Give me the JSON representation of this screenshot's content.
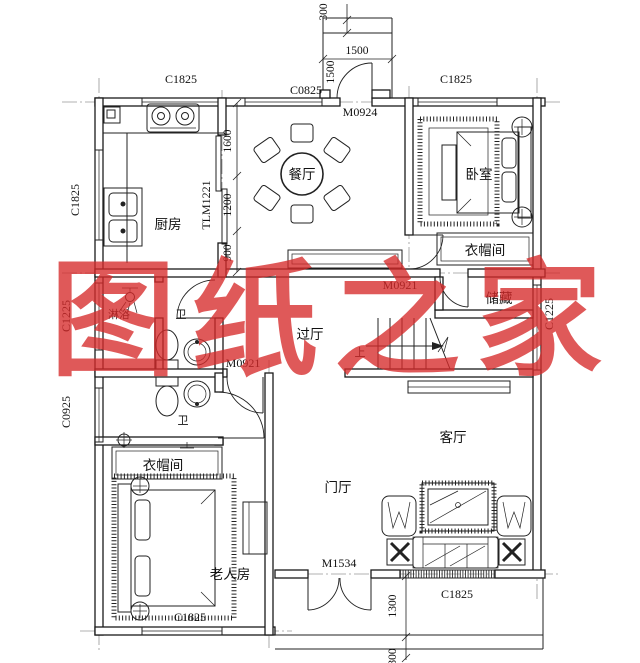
{
  "watermark": {
    "text": "图纸之家",
    "color": "#d62a2a"
  },
  "rooms": {
    "kitchen": "厨房",
    "dining": "餐厅",
    "bedroom": "卧室",
    "cloakroom_top": "衣帽间",
    "storage": "储藏",
    "hallway": "过厅",
    "shower": "淋浴",
    "bath_upper": "卫",
    "bath_lower": "卫",
    "cloakroom_bottom": "衣帽间",
    "elder_room": "老人房",
    "foyer": "门厅",
    "living_room": "客厅",
    "stairs_up": "上"
  },
  "openings": {
    "win_top_left": "C1825",
    "win_top_mid": "C0825",
    "door_top": "M0924",
    "win_top_right": "C1825",
    "win_left_kitchen": "C1825",
    "door_kitchen_sliding": "TLM1221",
    "win_left_shower": "C1225",
    "win_left_bath": "C0925",
    "win_right_storage": "C1225",
    "door_hall_upper": "M0921",
    "door_hall_lower": "M0921",
    "door_entry": "M1534",
    "win_bottom_left": "C1825",
    "win_living": "C1825"
  },
  "dimensions": {
    "shaft_offset": "300",
    "shaft_width": "1500",
    "shaft_depth": "1500",
    "dining_upper": "1600",
    "dining_mid": "1200",
    "dining_lower": "900",
    "porch_depth": "1300",
    "porch_step": "300"
  }
}
